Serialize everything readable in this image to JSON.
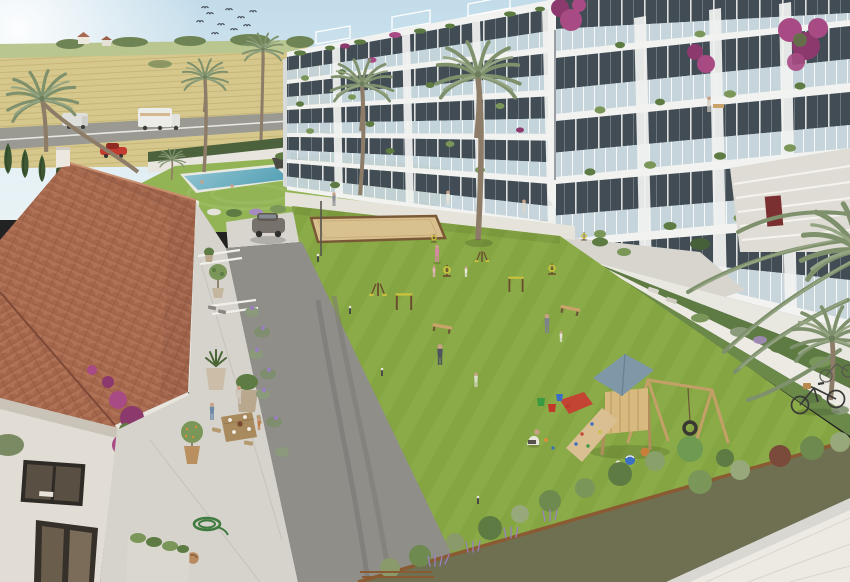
{
  "meta": {
    "kind": "architectural-render",
    "view": "elevated-aerial-courtyard",
    "time_of_day": "sunny-daytime"
  },
  "palette": {
    "sky1": "#c2dcea",
    "sky2": "#e9f3f6",
    "sun": "#ffffff",
    "field1": "#d6c78c",
    "fieldRow": "#c2b272",
    "distGreen": "#b9c68f",
    "treeGreen": "#6f8454",
    "cypress": "#3d5733",
    "roadFar": "#9a9a93",
    "asphalt": "#8f8e89",
    "asphaltDark": "#7b7a75",
    "concrete": "#d7d5cd",
    "pavement": "#eceae3",
    "whiteWalk": "#e5e3da",
    "lawn": "#8aab47",
    "lawnDark": "#80a23f",
    "poolLawn": "#92b455",
    "pool1": "#93c6d3",
    "pool2": "#58a2b6",
    "roofA": "#b07257",
    "roofB": "#96593f",
    "roofLine": "#7e4936",
    "wall": "#e2ddd4",
    "wallShade": "#c9c3b8",
    "bldg": "#f2f3f1",
    "slab": "#d8dbda",
    "facade": "#414c55",
    "glass": "#c3d3da",
    "plantDark": "#5d7b42",
    "plantMid": "#7a9659",
    "plantLight": "#97a87a",
    "palmA": "#7e906c",
    "palmB": "#95a583",
    "trunk": "#8d7d68",
    "boug": "#a84a84",
    "bougDeep": "#8c3a6e",
    "lavender": "#9a7fc0",
    "wood": "#c9a36a",
    "woodDark": "#8a5a33",
    "sand": "#d9c08f",
    "soil": "#6f7052",
    "skin": "#caa187",
    "red": "#c23b2e",
    "suv": "#76716a",
    "equip": "#6b4a2e",
    "equipY": "#c8c23e"
  },
  "scene": {
    "sky": {
      "bird_count": 10,
      "sun": "top-left-glare"
    },
    "background": {
      "features": [
        "wheat-fields",
        "farm-houses",
        "tree-line",
        "country-road",
        "guardrail",
        "cypress-hedge",
        "white-wall-hedge"
      ],
      "vehicles": [
        "white-van",
        "white-box-truck",
        "red-car"
      ]
    },
    "pool_area": {
      "swimmers": 2,
      "shrub_border": true,
      "small-palm": 1,
      "dark-planter": 1
    },
    "buildings": {
      "style": "white-modern-apartments-glass-balconies",
      "left_wing_floors": 5,
      "right_wing_floors": 5,
      "rooftop": [
        "glass-railing",
        "pergolas",
        "planting"
      ],
      "balcony_items": [
        "potted-plants",
        "bougainvillea",
        "sofa",
        "table",
        "residents"
      ]
    },
    "house": {
      "roof": "terracotta-tiles",
      "items": [
        "chimney",
        "dark-framed-windows",
        "bougainvillea",
        "family-dining-table",
        "potted-olive-trees",
        "garden-hose",
        "sleeping-cat",
        "planter"
      ]
    },
    "courtyard": {
      "lawn": "striped-mowing",
      "amenities": [
        "petanque-sand-court",
        "outdoor-gym",
        "benches",
        "bollard-lights",
        "playground"
      ],
      "playground": [
        "wooden-tower",
        "blue-gable-roof",
        "climbing-ramp",
        "tire-swing",
        "red-slide",
        "balls",
        "buckets"
      ],
      "people_approx": 14,
      "parked": [
        "gray-suv",
        "bicycles"
      ]
    }
  }
}
